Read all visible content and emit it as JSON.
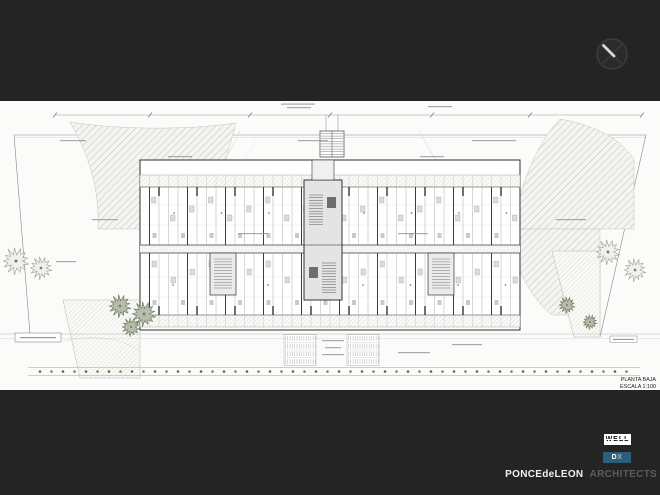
{
  "slide": {
    "background": "#242424"
  },
  "cursor": {
    "icon": "circle-x-icon"
  },
  "sheet": {
    "background": "#fbfbfa",
    "title": "PLANTA BAJA",
    "scale": "ESCALA 1:100"
  },
  "credits": {
    "well_label": "WELL",
    "dx_label_d": "D",
    "dx_label_x": "X",
    "firm_name": "PONCEdeLEON",
    "firm_suffix": "ARCHITECTS",
    "colors": {
      "well_bg": "#ffffff",
      "well_fg": "#0d0d0d",
      "dx_bg": "#2d5f7c",
      "dx_fg": "#ffffff",
      "dx_fg_dim": "#9cb8c8",
      "firm_fg": "#f0f0f0",
      "firm_suffix_fg": "#5c5c5c"
    }
  }
}
